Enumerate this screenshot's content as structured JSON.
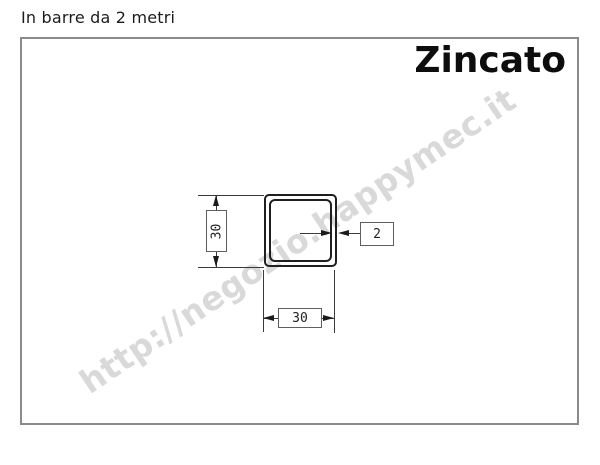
{
  "caption": "In barre da 2 metri",
  "panel": {
    "title": "Zincato"
  },
  "watermark": "http://negozio.happymec.it",
  "drawing": {
    "subject": "square-tube-cross-section",
    "height_label": "30",
    "width_label": "30",
    "thickness_label": "2"
  },
  "colors": {
    "frame_border": "#8a8a8a",
    "tube_line": "#1f1f1f",
    "dimension_line": "#3a3a3a",
    "watermark": "#d9d9d9",
    "text": "#1b1b1b"
  }
}
